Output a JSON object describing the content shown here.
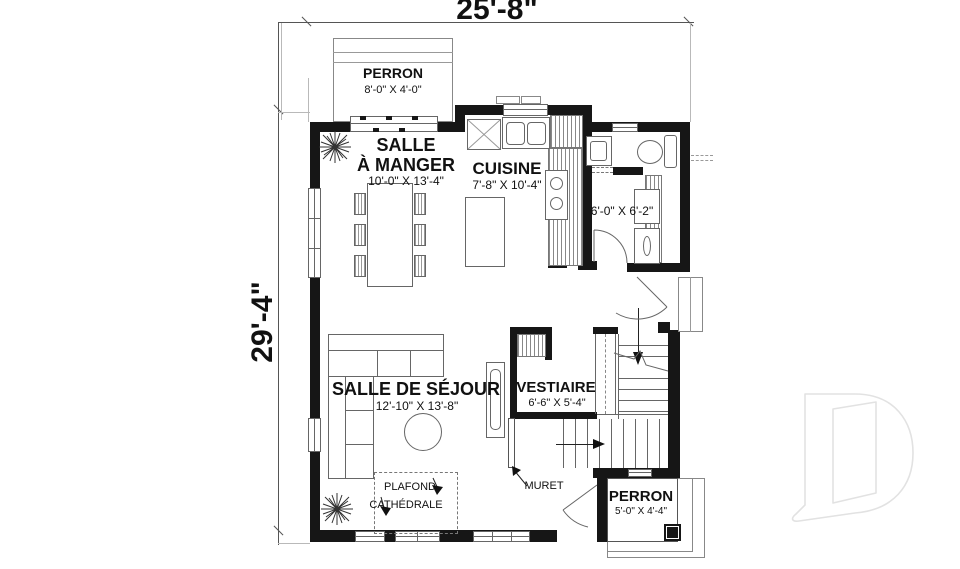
{
  "dimensions": {
    "overall_width": "25'-8\"",
    "overall_height": "29'-4\""
  },
  "rooms": {
    "perron_top": {
      "name": "PERRON",
      "dims": "8'-0\" X 4'-0\""
    },
    "dining": {
      "name_line1": "SALLE",
      "name_line2": "À MANGER",
      "dims": "10'-0\" X 13'-4\""
    },
    "kitchen": {
      "name": "CUISINE",
      "dims": "7'-8\" X 10'-4\""
    },
    "utility": {
      "dims": "6'-0\" X 6'-2\""
    },
    "living": {
      "name": "SALLE DE SÉJOUR",
      "dims": "12'-10\" X 13'-8\""
    },
    "vestibule": {
      "name": "VESTIAIRE",
      "dims": "6'-6\" X 5'-4\""
    },
    "perron_bottom": {
      "name": "PERRON",
      "dims": "5'-0\" X 4'-4\""
    }
  },
  "annotations": {
    "ceiling_line1": "PLAFOND",
    "ceiling_line2": "CATHÉDRALE",
    "low_wall": "MURET"
  },
  "colors": {
    "wall": "#161616",
    "thin_line": "#666666",
    "dimension_line": "#555555",
    "watermark": "#e2e2e2",
    "background": "#ffffff"
  }
}
